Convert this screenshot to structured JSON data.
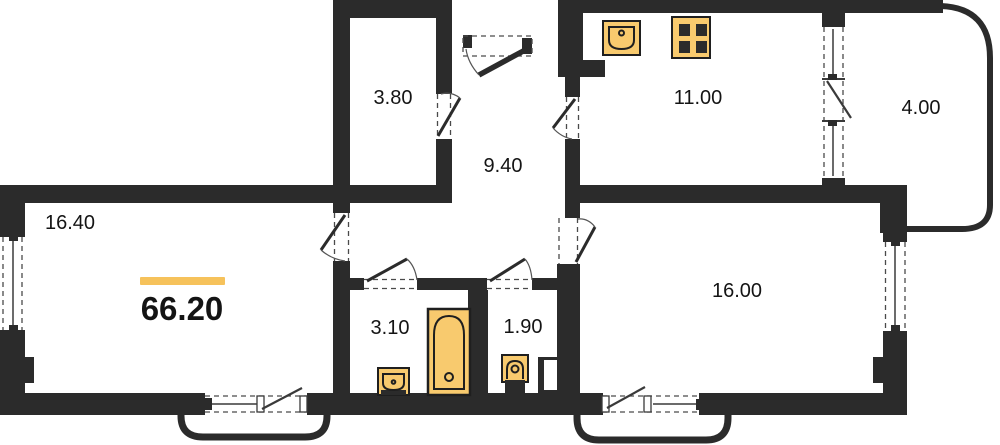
{
  "plan": {
    "total_area": "66.20",
    "rooms": {
      "living": {
        "area": "16.40"
      },
      "wardrobe": {
        "area": "3.80"
      },
      "hallway": {
        "area": "9.40"
      },
      "kitchen": {
        "area": "11.00"
      },
      "balcony": {
        "area": "4.00"
      },
      "bedroom": {
        "area": "16.00"
      },
      "bathroom": {
        "area": "3.10"
      },
      "wc": {
        "area": "1.90"
      }
    },
    "fixtures": [
      "kitchen-sink-icon",
      "stove-icon",
      "bathtub-icon",
      "washbasin-icon",
      "toilet-icon"
    ],
    "colors": {
      "walls": "#2b2b2b",
      "accent": "#f6c25b",
      "fixture_fill": "#f8ca6e",
      "fixture_stroke": "#1f1f1f",
      "label_ink": "#141414",
      "background": "#ffffff"
    }
  }
}
